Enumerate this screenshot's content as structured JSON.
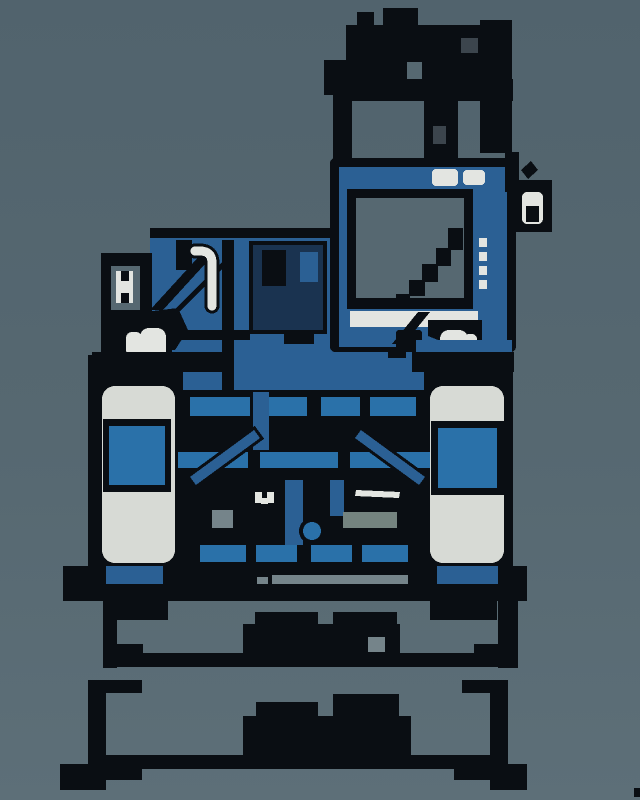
{
  "meta": {
    "title": "Front-view dimensional diagram of a blue wheeled machine",
    "canvas_width": 640,
    "canvas_height": 800
  },
  "colors": {
    "background": "#566871",
    "background_top": "#51636d",
    "background_bottom": "#5d6f78",
    "outline_black": "#0a0e13",
    "machine_blue": "#2b6094",
    "accent_blue": "#2a71a9",
    "shadow_navy": "#1a3350",
    "tire_light": "#d7dad5",
    "white_detail": "#e3e5e1",
    "gray_patch": "#75848a",
    "gray_dark_patch": "#3c454d",
    "gray_green_patch": "#74837f"
  },
  "diagram": {
    "view": "front elevation",
    "machine_parts": [
      "exhaust-and-boom-mast",
      "operator-cab",
      "cab-window",
      "windshield-wiper",
      "side-mirror",
      "cab-work-lights",
      "left-service-tower",
      "hydraulic-hose",
      "engine-hood",
      "left-headlight",
      "right-headlight",
      "left-wheel",
      "right-wheel",
      "axle-chassis",
      "ground-line"
    ],
    "dimensions": [
      {
        "id": "upper-width",
        "value_text": "",
        "rendering": "illegible pixelated dark blob"
      },
      {
        "id": "overall-width",
        "value_text": "",
        "rendering": "illegible pixelated dark blob"
      }
    ]
  }
}
